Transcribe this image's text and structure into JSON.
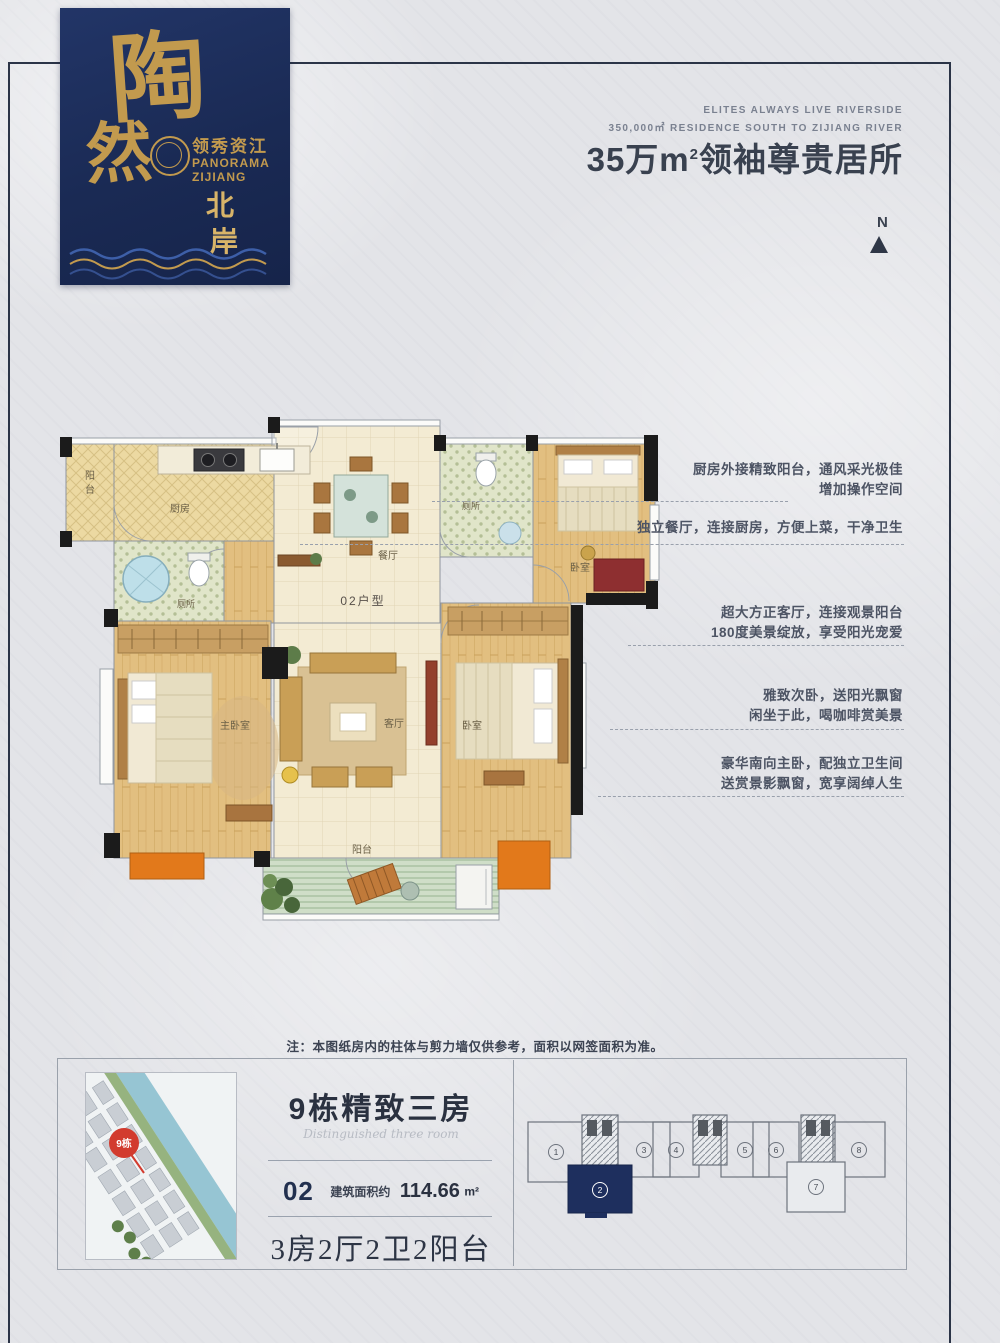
{
  "colors": {
    "page_bg": "#e3e4e8",
    "frame": "#2b3447",
    "logo_navy": "#1b2a54",
    "logo_gold": "#c29a4e",
    "headline_text": "#39414f",
    "annotation_text": "#4d5464",
    "wall_black": "#1b1b1b",
    "accent_orange": "#e2791b",
    "keyplan_navy": "#1e2f5e",
    "badge_red": "#d23b2e",
    "kitchen_floor": "#ecd9a2",
    "bath_floor": "#e0e5c9",
    "wood_floor": "#e2bf80",
    "hall_floor": "#f3ebd3",
    "balcony_floor": "#cfdec8"
  },
  "logo": {
    "char1": "陶",
    "char2": "然",
    "cn_title": "领秀资江",
    "en1": "PANORAMA",
    "en2": "ZIJIANG",
    "vert1": "北",
    "vert2": "岸"
  },
  "header": {
    "en_line1": "ELITES ALWAYS LIVE RIVERSIDE",
    "en_line2": "350,000㎡ RESIDENCE SOUTH TO ZIJIANG RIVER",
    "headline_prefix": "35万m",
    "headline_sup": "2",
    "headline_suffix": "领袖尊贵居所",
    "north_label": "N"
  },
  "floorplan": {
    "unit_label": "02户型",
    "rooms": {
      "balcony_top_1": "阳",
      "balcony_top_2": "台",
      "kitchen": "厨房",
      "bath1": "厕所",
      "dining": "餐厅",
      "bath2": "厕所",
      "bedroom2": "卧室",
      "master": "主卧室",
      "living": "客厅",
      "bedroom3": "卧室",
      "balcony_bottom": "阳台"
    },
    "annotations": [
      {
        "line1": "厨房外接精致阳台，通风采光极佳",
        "line2": "增加操作空间"
      },
      {
        "line1": "独立餐厅，连接厨房，方便上菜，干净卫生",
        "line2": ""
      },
      {
        "line1": "超大方正客厅，连接观景阳台",
        "line2": "180度美景绽放，享受阳光宠爱"
      },
      {
        "line1": "雅致次卧，送阳光飘窗",
        "line2": "闲坐于此，喝咖啡赏美景"
      },
      {
        "line1": "豪华南向主卧，配独立卫生间",
        "line2": "送赏景影飘窗，宽享阔绰人生"
      }
    ]
  },
  "note": {
    "text": "注：本图纸房内的柱体与剪力墙仅供参考，面积以网签面积为准。"
  },
  "footer": {
    "badge": "9栋",
    "title": "9栋精致三房",
    "script_line": "Distinguished three room",
    "unit_no": "02",
    "area_label": "建筑面积约",
    "area_value": "114.66",
    "area_unit": "m²",
    "layout_text": "3房2厅2卫2阳台",
    "keyplan": {
      "units": [
        "1",
        "2",
        "3",
        "4",
        "5",
        "6",
        "7",
        "8"
      ]
    }
  }
}
